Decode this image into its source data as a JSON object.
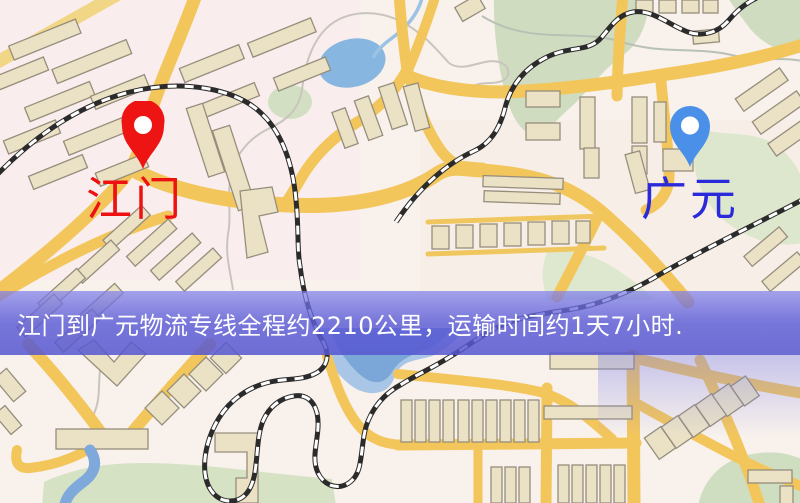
{
  "map": {
    "origin": {
      "label": "江门",
      "pin_color": "#ee1414",
      "label_color": "#ed1111"
    },
    "destination": {
      "label": "广元",
      "pin_color": "#4a90e8",
      "label_color": "#2a2ada"
    }
  },
  "banner": {
    "text": "江门到广元物流专线全程约2210公里，运输时间约1天7小时.",
    "bg_color": "#5c5cd2",
    "text_color": "#ffffff"
  },
  "map_style": {
    "background": "#f8f1ec",
    "road": "#f3c65c",
    "railway": "#2b2b2b",
    "water": "#87b7e0",
    "park": "#cfdcc0",
    "building": "#ebe2c6"
  }
}
